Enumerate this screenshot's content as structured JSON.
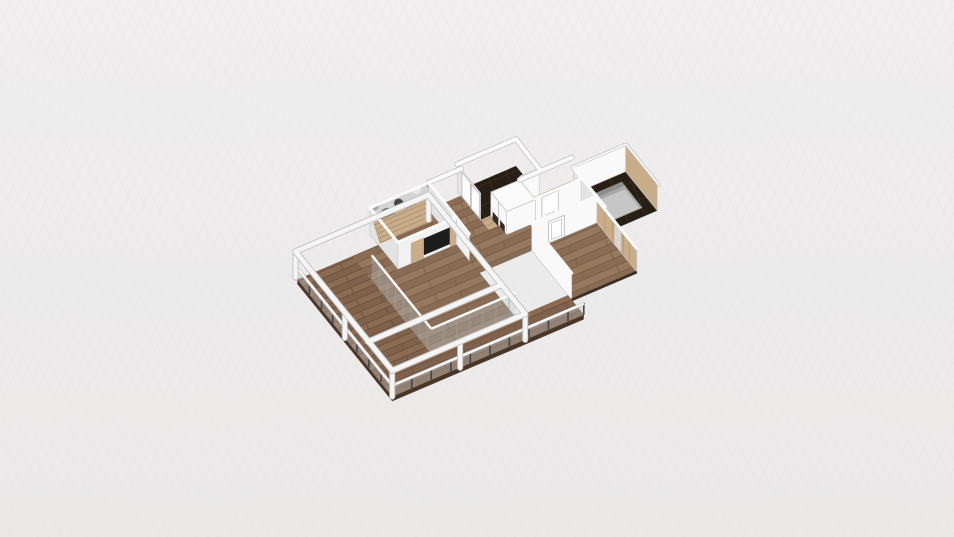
{
  "viewport": {
    "kind": "3d-floorplan-render",
    "background": "#edecec"
  },
  "colors": {
    "background": "#edecec",
    "wood_base": "#96785f",
    "wood_alt": "#8a6c55",
    "wood_line": "#7a5e48",
    "terrace_base": "#8c6b53",
    "terrace_alt": "#80614b",
    "terrace_line": "#6d513e",
    "tan": "#c9ad8a",
    "tan_line": "#ae9070",
    "dark_floor": "#271e16",
    "dark_line": "#392b1e",
    "wall_bright": "#f9f9f9",
    "wall_light": "#f1f1f1",
    "wall_shade": "#e3e3e3",
    "cap_white": "#fafafa",
    "cap_under": "#bfbfbf",
    "beam_white": "#f5f5f5",
    "beam_edge": "#c2c2c2",
    "glass": "rgba(185,198,206,0.32)",
    "mullion": "#9aa0a3",
    "railing_post": "#43444a",
    "deck_edge": "#4a3626",
    "tv_panel": "#1d1d1d",
    "bed_gray": "#a8a8a8",
    "bed_light": "#c6c6c6",
    "bed_dark": "#8d8d8d",
    "door_white": "#fdfdfd",
    "door_frame": "#b9b9b9",
    "camo_base": "#d4d4d4",
    "camo_mid": "#a7a7a7",
    "camo_dark": "#6e6e6e",
    "camo_darker": "#454545",
    "camo_light": "#e9e9e9",
    "mirror": "#d9d6d0",
    "shelf_dark": "#342a1f",
    "base_strip": "#3a2d22"
  }
}
